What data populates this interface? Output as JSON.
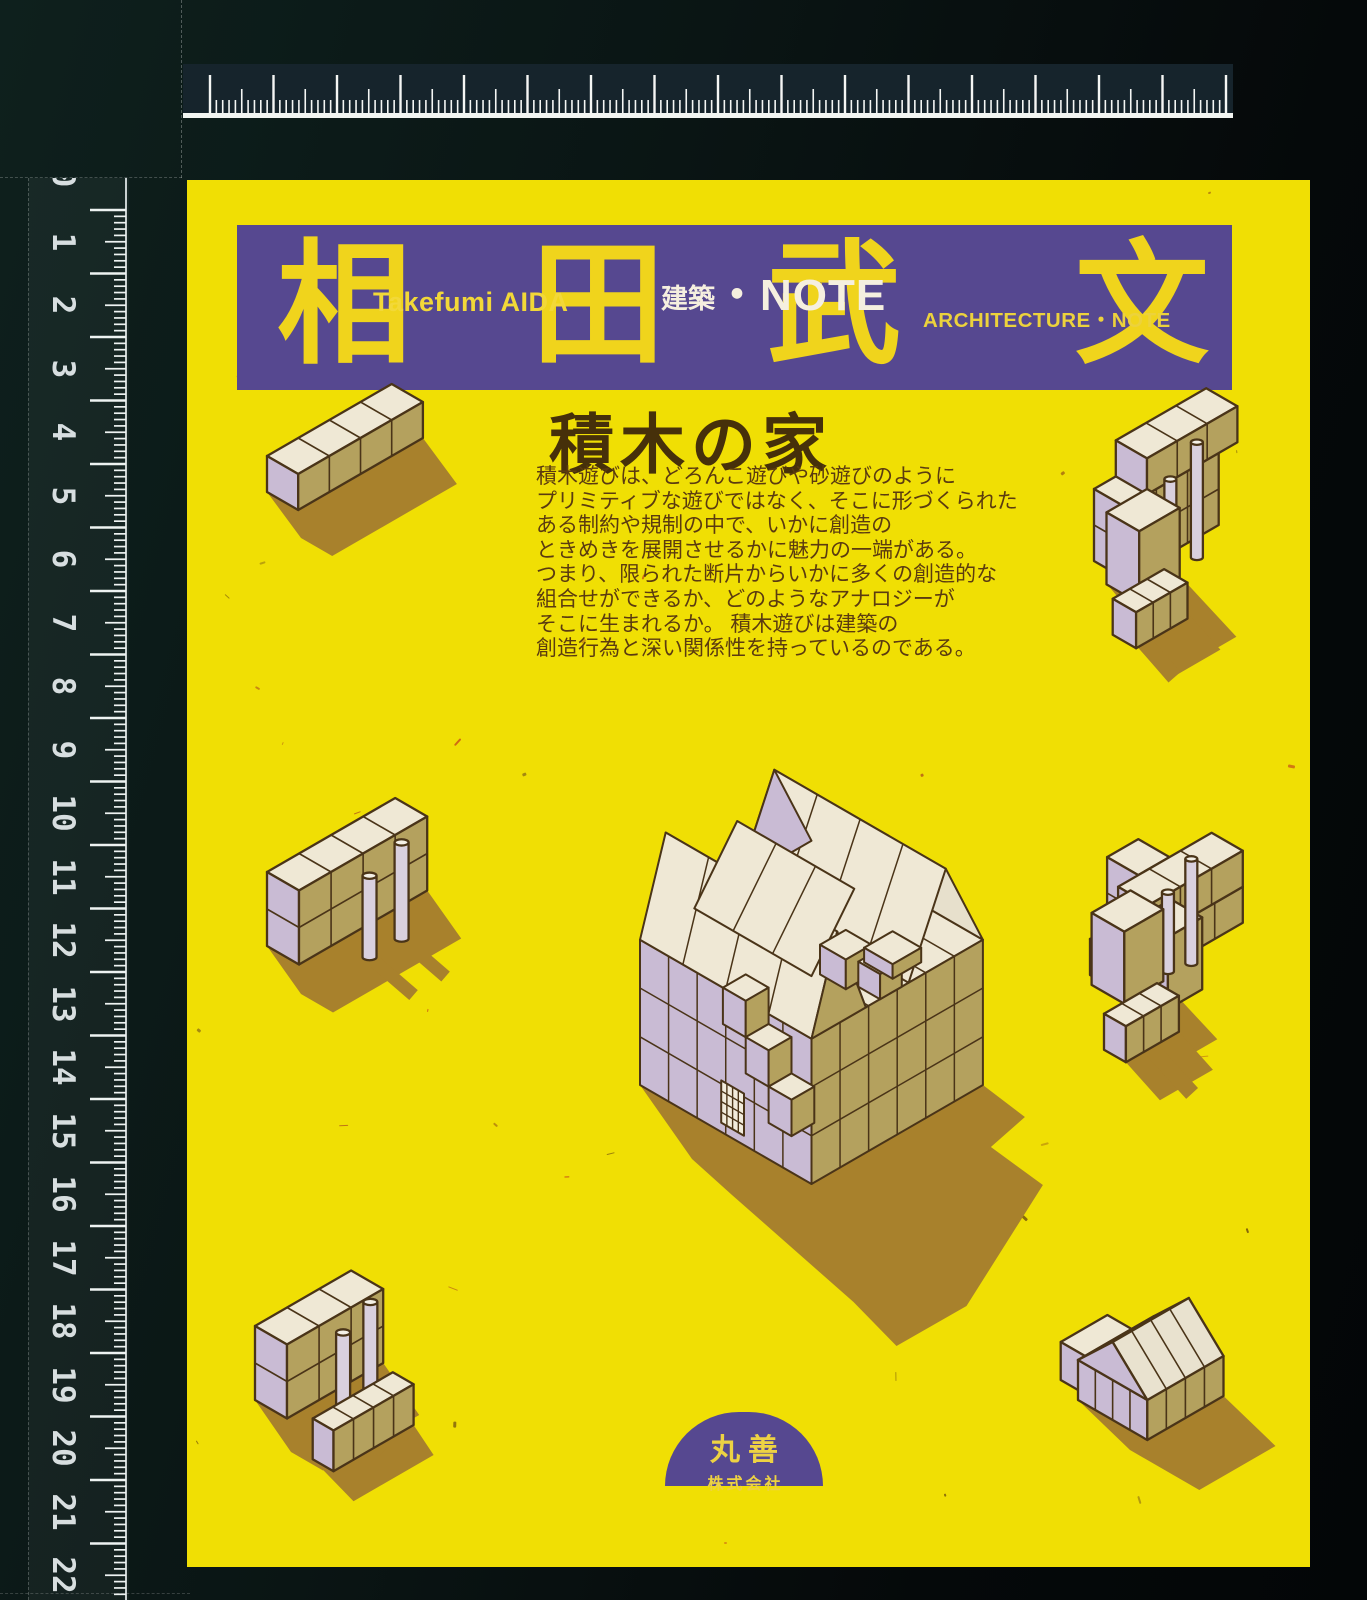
{
  "rulers": {
    "left_numbers": [
      "0",
      "1",
      "2",
      "3",
      "4",
      "5",
      "6",
      "7",
      "8",
      "9",
      "10",
      "11",
      "12",
      "13",
      "14",
      "15",
      "16",
      "17",
      "18",
      "19",
      "20",
      "21",
      "22"
    ]
  },
  "cover": {
    "banner": {
      "kanji": [
        "相",
        "田",
        "武",
        "文"
      ],
      "author_romaji": "Takefumi AIDA",
      "series_jp_small": "建築",
      "series_jp_large": "・NOTE",
      "series_en": "ARCHITECTURE・NOTE"
    },
    "title": "積木の家",
    "intro_lines": [
      "積木遊びは、どろんこ遊びや砂遊びのように",
      "プリミティブな遊びではなく、そこに形づくられた",
      "ある制約や規制の中で、いかに創造の",
      "ときめきを展開させるかに魅力の一端がある。",
      "つまり、限られた断片からいかに多くの創造的な",
      "組合せができるか、どのようなアナロジーが",
      "そこに生まれるか。 積木遊びは建築の",
      "創造行為と深い関係性を持っているのである。"
    ],
    "publisher": {
      "name": "丸善",
      "suffix": "株式会社"
    }
  },
  "colors": {
    "cover_yellow": "#f0df04",
    "banner_purple": "#564890",
    "accent_yellow": "#f0d41c",
    "title_brown": "#46300a",
    "body_brown": "#5b3b10",
    "shadow_brown": "#a8812c",
    "block_top": "#efe8d5",
    "block_tan": "#b4a15e",
    "block_lavender": "#c9bbd4",
    "outline_brown": "#4a3418"
  }
}
